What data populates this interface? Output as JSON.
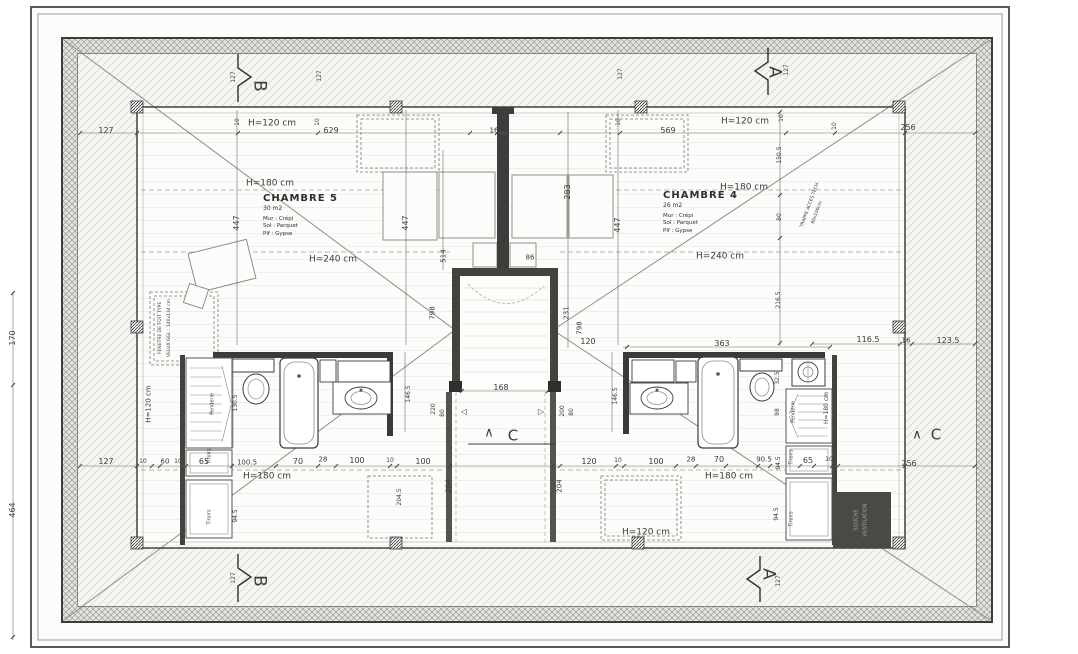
{
  "drawing": {
    "type_label": "floor-plan-attic-level",
    "ink_color": "#3b3b39",
    "wall_dark": "#44423e",
    "vent_box_color": "#4a4946",
    "paper_color": "#fcfcfa"
  },
  "rooms": [
    {
      "name": "CHAMBRE 5",
      "area": "30 m2",
      "specs": [
        "Mur : Crépi",
        "Sol : Parquet",
        "Plf : Gypse"
      ]
    },
    {
      "name": "CHAMBRE 4",
      "area": "26 m2",
      "specs": [
        "Mur : Crépi",
        "Sol : Parquet",
        "Plf : Gypse"
      ]
    }
  ],
  "room_positions": [
    {
      "x": 263,
      "y": 193
    },
    {
      "x": 663,
      "y": 190
    }
  ],
  "annotations": [
    {
      "t": "127",
      "x": 106,
      "y": 131
    },
    {
      "t": "10",
      "x": 238,
      "y": 122,
      "r": -90,
      "s": 6
    },
    {
      "t": "H=120 cm",
      "x": 272,
      "y": 124,
      "s": 9
    },
    {
      "t": "10",
      "x": 318,
      "y": 122,
      "r": -90,
      "s": 6
    },
    {
      "t": "629",
      "x": 331,
      "y": 131
    },
    {
      "t": "16",
      "x": 494,
      "y": 131,
      "s": 7
    },
    {
      "t": "10",
      "x": 619,
      "y": 122,
      "r": -90,
      "s": 6
    },
    {
      "t": "569",
      "x": 668,
      "y": 131
    },
    {
      "t": "H=120 cm",
      "x": 745,
      "y": 122,
      "s": 9
    },
    {
      "t": "10",
      "x": 782,
      "y": 118,
      "r": -90,
      "s": 6
    },
    {
      "t": "10",
      "x": 835,
      "y": 126,
      "r": -90,
      "s": 6
    },
    {
      "t": "256",
      "x": 908,
      "y": 128
    },
    {
      "t": "127",
      "x": 234,
      "y": 77,
      "r": -90,
      "s": 6
    },
    {
      "t": "127",
      "x": 320,
      "y": 76,
      "r": -90,
      "s": 6
    },
    {
      "t": "127",
      "x": 621,
      "y": 74,
      "r": -90,
      "s": 6
    },
    {
      "t": "127",
      "x": 787,
      "y": 70,
      "r": -90,
      "s": 6
    },
    {
      "t": "B",
      "x": 259,
      "y": 86,
      "r": 90,
      "s": 17
    },
    {
      "t": "A",
      "x": 774,
      "y": 72,
      "r": 90,
      "s": 17
    },
    {
      "t": "B",
      "x": 259,
      "y": 581,
      "r": 90,
      "s": 17
    },
    {
      "t": "A",
      "x": 768,
      "y": 574,
      "r": 90,
      "s": 17
    },
    {
      "t": "C",
      "x": 513,
      "y": 436,
      "s": 15
    },
    {
      "t": "∧",
      "x": 489,
      "y": 433,
      "s": 13
    },
    {
      "t": "C",
      "x": 936,
      "y": 435,
      "s": 15
    },
    {
      "t": "∧",
      "x": 917,
      "y": 435,
      "s": 13
    },
    {
      "t": "170",
      "x": 13,
      "y": 338,
      "r": -90
    },
    {
      "t": "464",
      "x": 13,
      "y": 510,
      "r": -90
    },
    {
      "t": "H=120 cm",
      "x": 149,
      "y": 404,
      "r": -90,
      "s": 7
    },
    {
      "t": "127",
      "x": 106,
      "y": 462
    },
    {
      "t": "127",
      "x": 234,
      "y": 578,
      "r": -90,
      "s": 6
    },
    {
      "t": "127",
      "x": 779,
      "y": 581,
      "r": -90,
      "s": 6
    },
    {
      "t": "H=180 cm",
      "x": 270,
      "y": 184,
      "s": 9
    },
    {
      "t": "H=180 cm",
      "x": 744,
      "y": 188,
      "s": 9
    },
    {
      "t": "H=240 cm",
      "x": 333,
      "y": 260,
      "s": 9
    },
    {
      "t": "H=240 cm",
      "x": 720,
      "y": 257,
      "s": 9
    },
    {
      "t": "H=180 cm",
      "x": 267,
      "y": 477,
      "s": 9
    },
    {
      "t": "H=180 cm",
      "x": 729,
      "y": 477,
      "s": 9
    },
    {
      "t": "H=120 cm",
      "x": 646,
      "y": 533,
      "s": 9
    },
    {
      "t": "H=180 cm",
      "x": 827,
      "y": 408,
      "r": -90,
      "s": 6
    },
    {
      "t": "447",
      "x": 237,
      "y": 223,
      "r": -90
    },
    {
      "t": "447",
      "x": 406,
      "y": 223,
      "r": -90
    },
    {
      "t": "447",
      "x": 618,
      "y": 225,
      "r": -90
    },
    {
      "t": "514",
      "x": 444,
      "y": 256,
      "r": -90,
      "s": 7
    },
    {
      "t": "86",
      "x": 530,
      "y": 258,
      "s": 7
    },
    {
      "t": "283",
      "x": 568,
      "y": 192,
      "r": -90
    },
    {
      "t": "231",
      "x": 567,
      "y": 313,
      "r": -90,
      "s": 7
    },
    {
      "t": "798",
      "x": 580,
      "y": 328,
      "r": -90,
      "s": 7
    },
    {
      "t": "798",
      "x": 433,
      "y": 313,
      "r": -90,
      "s": 7
    },
    {
      "t": "120",
      "x": 588,
      "y": 342,
      "s": 8
    },
    {
      "t": "168",
      "x": 501,
      "y": 388,
      "s": 8
    },
    {
      "t": "146.5",
      "x": 616,
      "y": 396,
      "r": -90,
      "s": 6
    },
    {
      "t": "146.5",
      "x": 409,
      "y": 394,
      "r": -90,
      "s": 6
    },
    {
      "t": "220",
      "x": 434,
      "y": 409,
      "r": -90,
      "s": 6
    },
    {
      "t": "80",
      "x": 443,
      "y": 413,
      "r": -90,
      "s": 6
    },
    {
      "t": "200",
      "x": 563,
      "y": 411,
      "r": -90,
      "s": 6
    },
    {
      "t": "80",
      "x": 572,
      "y": 412,
      "r": -90,
      "s": 6
    },
    {
      "t": "◁",
      "x": 464,
      "y": 412,
      "s": 8
    },
    {
      "t": "▷",
      "x": 541,
      "y": 412,
      "s": 8
    },
    {
      "t": "204",
      "x": 449,
      "y": 486,
      "r": -90,
      "s": 7
    },
    {
      "t": "204",
      "x": 560,
      "y": 486,
      "r": -90,
      "s": 7
    },
    {
      "t": "204.5",
      "x": 400,
      "y": 497,
      "r": -90,
      "s": 6
    },
    {
      "t": "94.5",
      "x": 236,
      "y": 516,
      "r": -90,
      "s": 6
    },
    {
      "t": "94.5",
      "x": 777,
      "y": 514,
      "r": -90,
      "s": 6
    },
    {
      "t": "130.5",
      "x": 236,
      "y": 403,
      "r": -90,
      "s": 6
    },
    {
      "t": "363",
      "x": 722,
      "y": 344,
      "s": 8
    },
    {
      "t": "116.5",
      "x": 868,
      "y": 340,
      "s": 8
    },
    {
      "t": "16",
      "x": 906,
      "y": 341,
      "s": 7
    },
    {
      "t": "123.5",
      "x": 948,
      "y": 341,
      "s": 8
    },
    {
      "t": "150.5",
      "x": 780,
      "y": 155,
      "r": -90,
      "s": 6
    },
    {
      "t": "80",
      "x": 780,
      "y": 217,
      "r": -90,
      "s": 6
    },
    {
      "t": "216.5",
      "x": 779,
      "y": 300,
      "r": -90,
      "s": 6
    },
    {
      "t": "32.5",
      "x": 778,
      "y": 378,
      "r": -90,
      "s": 6
    },
    {
      "t": "98",
      "x": 778,
      "y": 412,
      "r": -90,
      "s": 6
    },
    {
      "t": "90.5",
      "x": 764,
      "y": 460,
      "s": 7
    },
    {
      "t": "94.5",
      "x": 779,
      "y": 463,
      "r": -90,
      "s": 6
    },
    {
      "t": "10",
      "x": 143,
      "y": 462,
      "s": 6
    },
    {
      "t": "60",
      "x": 165,
      "y": 462,
      "s": 7
    },
    {
      "t": "10",
      "x": 178,
      "y": 462,
      "s": 6
    },
    {
      "t": "65",
      "x": 204,
      "y": 462,
      "s": 8
    },
    {
      "t": "100.5",
      "x": 247,
      "y": 463,
      "s": 7
    },
    {
      "t": "70",
      "x": 298,
      "y": 462,
      "s": 8
    },
    {
      "t": "28",
      "x": 323,
      "y": 460,
      "s": 7
    },
    {
      "t": "100",
      "x": 357,
      "y": 461,
      "s": 8
    },
    {
      "t": "10",
      "x": 390,
      "y": 461,
      "s": 6
    },
    {
      "t": "100",
      "x": 423,
      "y": 462,
      "s": 8
    },
    {
      "t": "120",
      "x": 589,
      "y": 462,
      "s": 8
    },
    {
      "t": "10",
      "x": 618,
      "y": 461,
      "s": 6
    },
    {
      "t": "100",
      "x": 656,
      "y": 462,
      "s": 8
    },
    {
      "t": "28",
      "x": 691,
      "y": 460,
      "s": 7
    },
    {
      "t": "70",
      "x": 719,
      "y": 460,
      "s": 8
    },
    {
      "t": "65",
      "x": 808,
      "y": 461,
      "s": 8
    },
    {
      "t": "10",
      "x": 829,
      "y": 460,
      "s": 6
    },
    {
      "t": "256",
      "x": 909,
      "y": 464,
      "s": 8
    },
    {
      "t": "Penderie",
      "x": 213,
      "y": 404,
      "r": -90,
      "s": 5
    },
    {
      "t": "Penderie",
      "x": 794,
      "y": 412,
      "r": -90,
      "s": 5
    },
    {
      "t": "Tiroirs",
      "x": 210,
      "y": 456,
      "r": -90,
      "s": 5
    },
    {
      "t": "Tiroirs",
      "x": 210,
      "y": 517,
      "r": -90,
      "s": 5
    },
    {
      "t": "Tiroirs",
      "x": 792,
      "y": 457,
      "r": -90,
      "s": 5
    },
    {
      "t": "Tiroirs",
      "x": 792,
      "y": 519,
      "r": -90,
      "s": 5
    },
    {
      "t": "TRAPPE ACCES TECH.",
      "x": 811,
      "y": 205,
      "r": -70,
      "s": 4.5
    },
    {
      "t": "80x100cm",
      "x": 818,
      "y": 213,
      "r": -70,
      "s": 4.5
    },
    {
      "t": "FENETRE DE TOIT TYPE",
      "x": 161,
      "y": 328,
      "r": -90,
      "s": 4.5
    },
    {
      "t": "VELUX GGL : 140x134 cm",
      "x": 170,
      "y": 328,
      "r": -90,
      "s": 4.5
    },
    {
      "t": "SOUCHE",
      "x": 857,
      "y": 520,
      "r": -90,
      "s": 5,
      "c": "#a0a09c"
    },
    {
      "t": "VENTILATION",
      "x": 866,
      "y": 520,
      "r": -90,
      "s": 5,
      "c": "#a0a09c"
    }
  ]
}
